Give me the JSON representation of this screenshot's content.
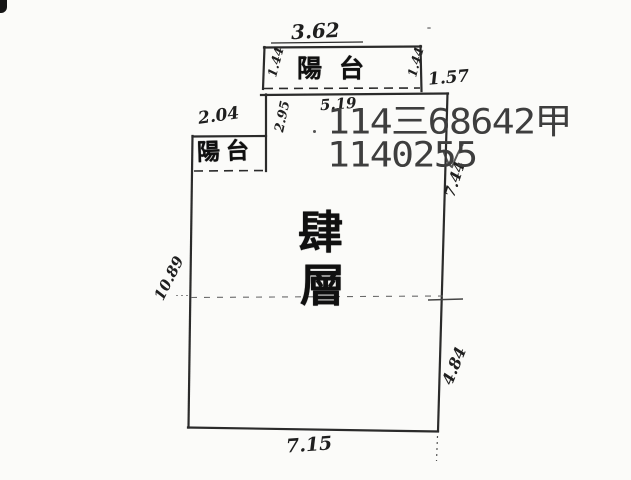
{
  "document": {
    "kind": "scanned-floor-plan",
    "stamp": {
      "line1": "114三68642甲",
      "line2": "1140255"
    },
    "floor_label": {
      "full": "肆層",
      "char1": "肆",
      "char2": "層"
    },
    "balconies": {
      "top_label": "陽台",
      "left_label": "陽台"
    },
    "dimensions": {
      "top_balcony_width": "3.62",
      "top_balcony_side_left": "1.44",
      "top_balcony_side_right": "1.44",
      "top_right_offset": "1.57",
      "top_wall_width": "5.19",
      "left_balcony_width": "2.04",
      "upper_left_step_height": "2.95",
      "right_wall_upper": "7.44",
      "right_wall_lower": "4.84",
      "left_wall": "10.89",
      "bottom_wall": "7.15"
    },
    "colors": {
      "ink": "#2b2b2b",
      "stamp": "#3e3e3e",
      "paper": "#fbfbf9",
      "faint": "#777777"
    }
  }
}
